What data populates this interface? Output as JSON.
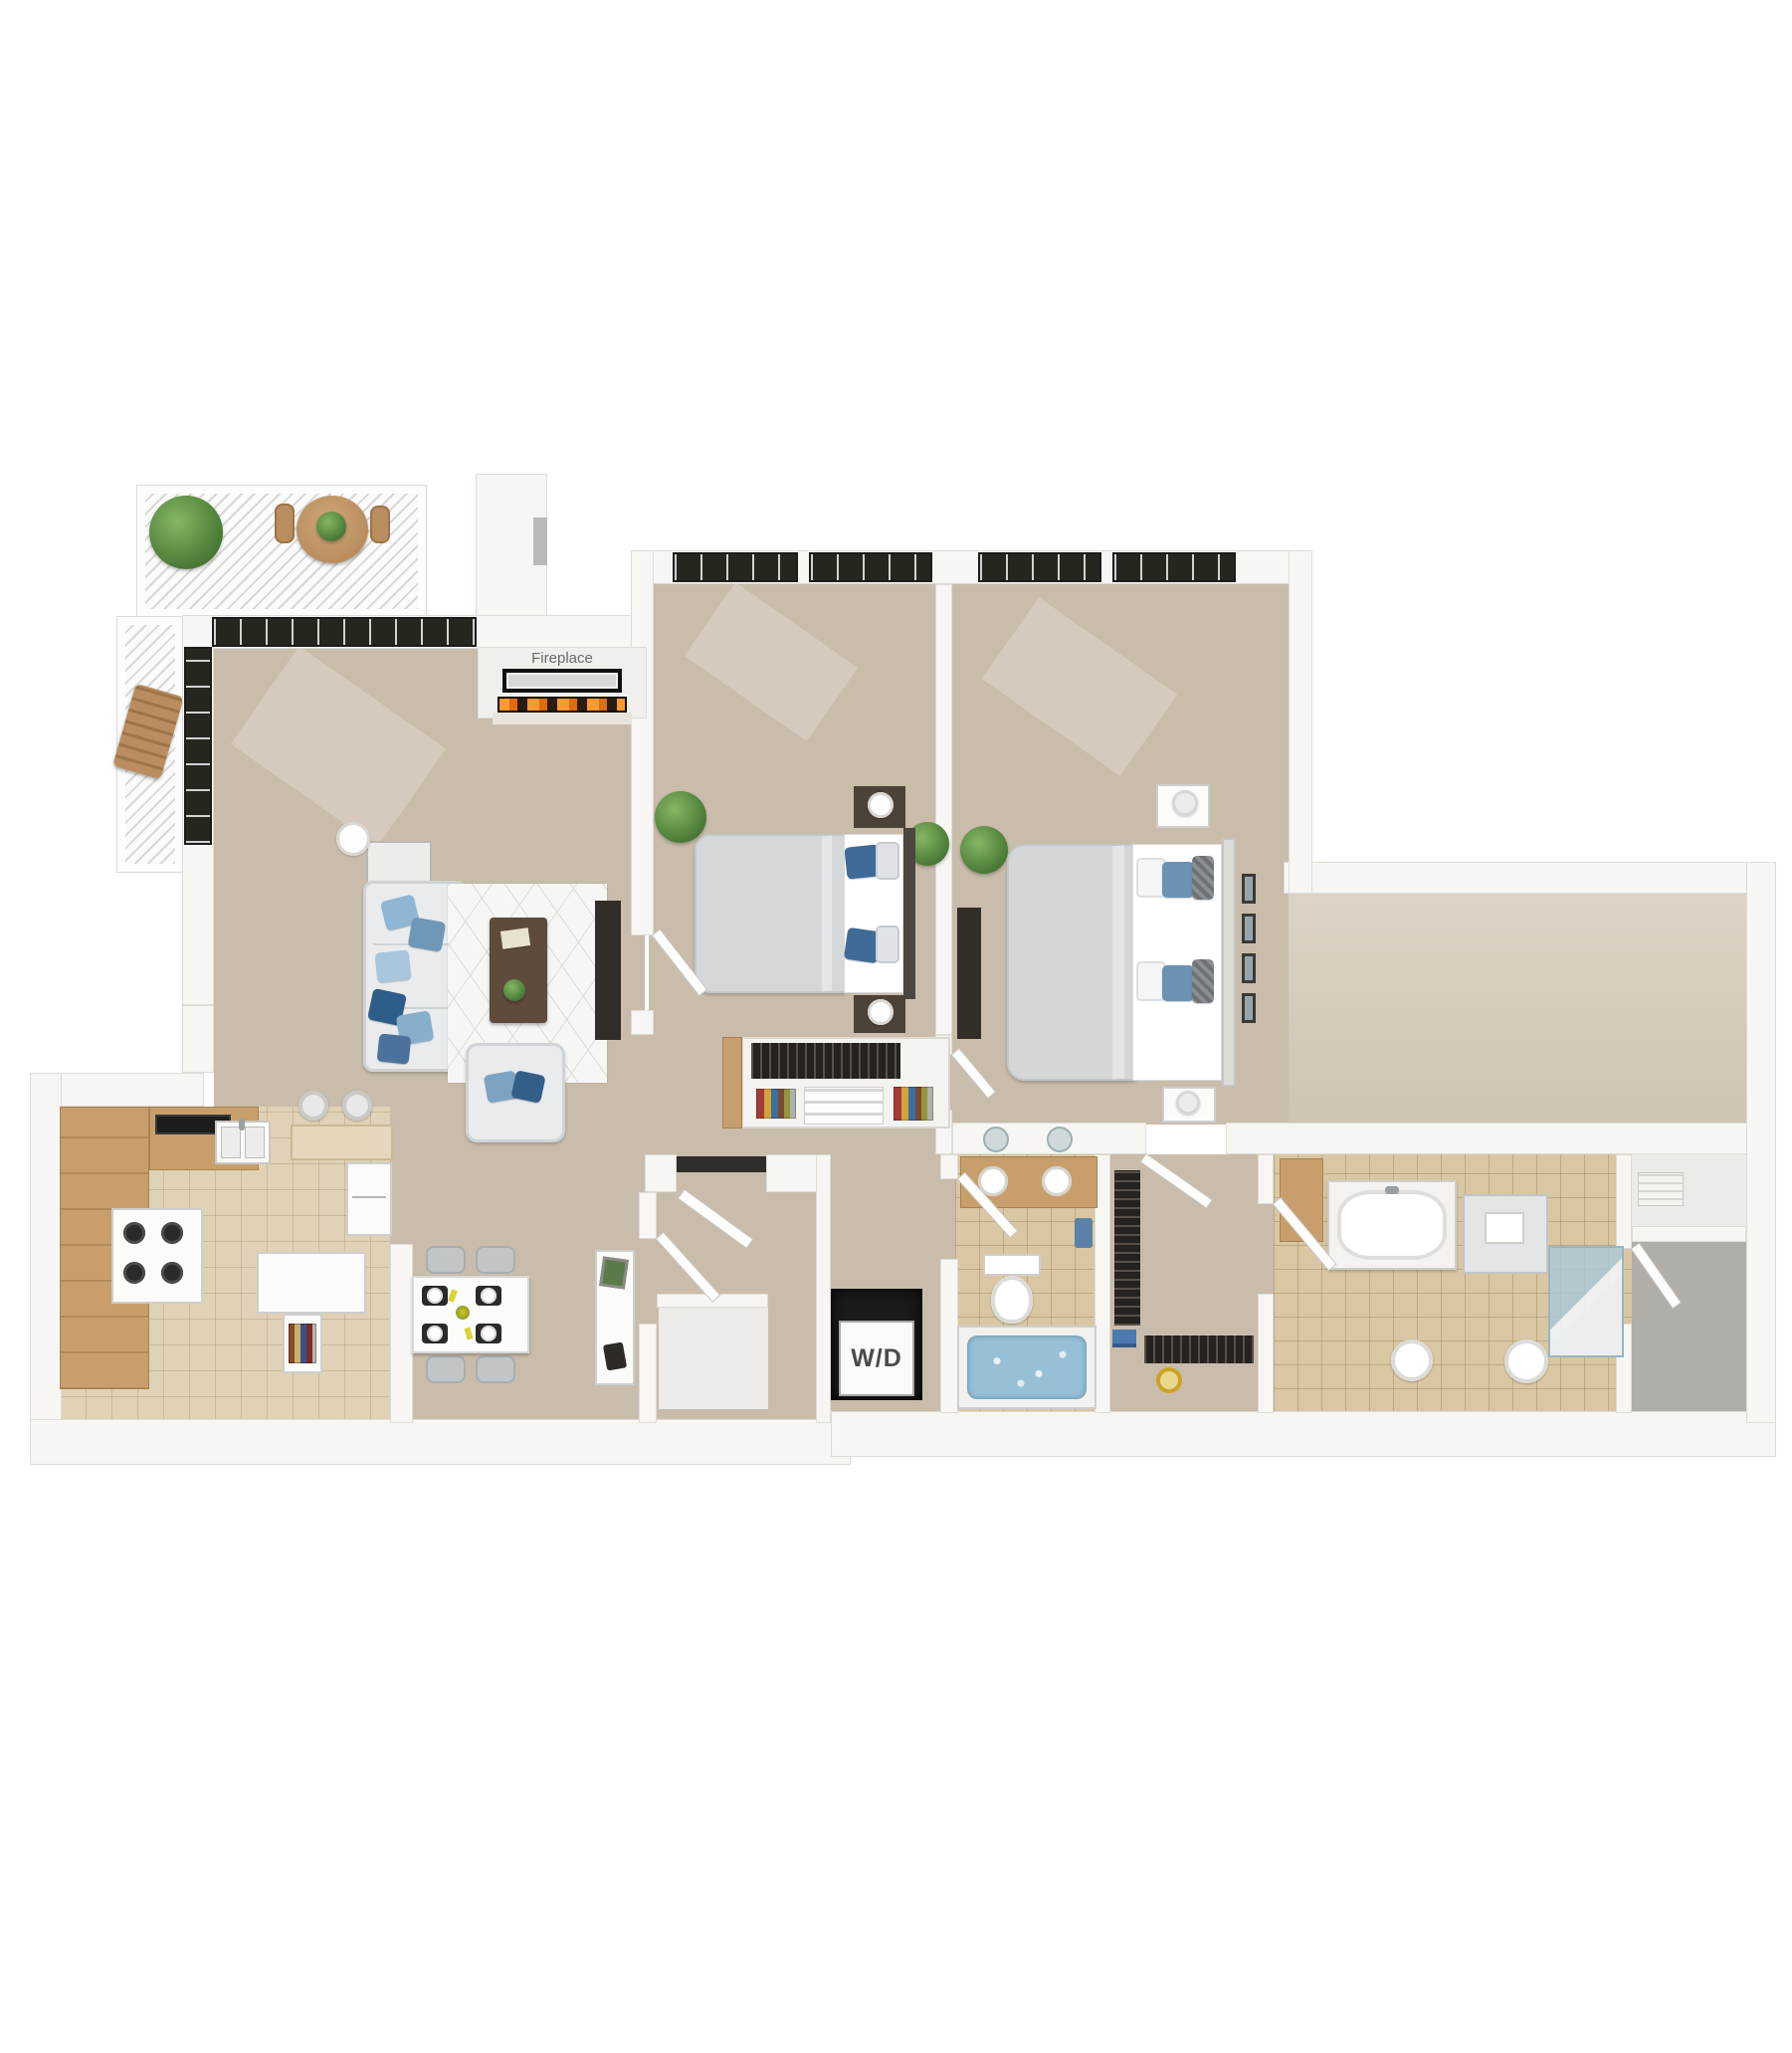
{
  "plan": {
    "type": "3d-floor-plan",
    "labels": {
      "fireplace": "Fireplace",
      "washer_dryer": "W/D"
    },
    "colors": {
      "background": "#ffffff",
      "wall": "#f7f6f3",
      "floor": "#c9bcab",
      "kitchen_tile": "#e0d2b6",
      "bath_tile": "#d9c7a4",
      "wood": "#c89f6c",
      "window_frame": "#26261f",
      "accent_blue": "#6b92b4",
      "deep_blue": "#2f5d8a",
      "plant_green": "#4a7a36",
      "water_blue": "#97c0d6",
      "flame_orange": "#e06a10",
      "dark_furniture": "#332d27",
      "gray_floor": "#b1ada8"
    },
    "rooms": [
      {
        "name": "balcony",
        "items": [
          "potted-plant",
          "round-table",
          "patio-chairs",
          "lounge-chair"
        ]
      },
      {
        "name": "living-room",
        "items": [
          "corner-windows",
          "fireplace",
          "wall-art",
          "sofa",
          "blue-pillows",
          "area-rug",
          "coffee-table",
          "armchair",
          "tv-console",
          "console-table",
          "floor-lamp"
        ]
      },
      {
        "name": "bedroom-1",
        "items": [
          "windows",
          "double-bed",
          "nightstands",
          "table-lamps",
          "potted-plants",
          "closet",
          "bookshelves"
        ]
      },
      {
        "name": "bedroom-2",
        "items": [
          "windows",
          "double-bed",
          "nightstands",
          "table-lamps",
          "tv-console",
          "wall-art-frames",
          "potted-plant"
        ]
      },
      {
        "name": "kitchen",
        "items": [
          "l-shaped-counter",
          "cooktop",
          "double-sink",
          "stove",
          "refrigerator",
          "breakfast-bar",
          "bar-stools",
          "island",
          "bottle-shelf"
        ]
      },
      {
        "name": "dining-area",
        "items": [
          "dining-table",
          "four-chairs",
          "place-settings",
          "console-table"
        ]
      },
      {
        "name": "entry",
        "items": [
          "front-door",
          "coat-closet"
        ]
      },
      {
        "name": "laundry-closet",
        "items": [
          "washer-dryer"
        ]
      },
      {
        "name": "bathroom-1",
        "items": [
          "wood-vanity",
          "round-sinks",
          "mirrors",
          "toilet",
          "jacuzzi-tub",
          "towels"
        ]
      },
      {
        "name": "walk-in-closet",
        "items": [
          "clothes-racks",
          "gold-mirror",
          "linens"
        ]
      },
      {
        "name": "bathroom-2",
        "items": [
          "bathtub",
          "vanity-cabinet",
          "corner-shower",
          "pedestal-sinks",
          "wood-cabinet"
        ]
      },
      {
        "name": "storage",
        "items": [
          "bench",
          "gray-floor-room"
        ]
      }
    ]
  }
}
